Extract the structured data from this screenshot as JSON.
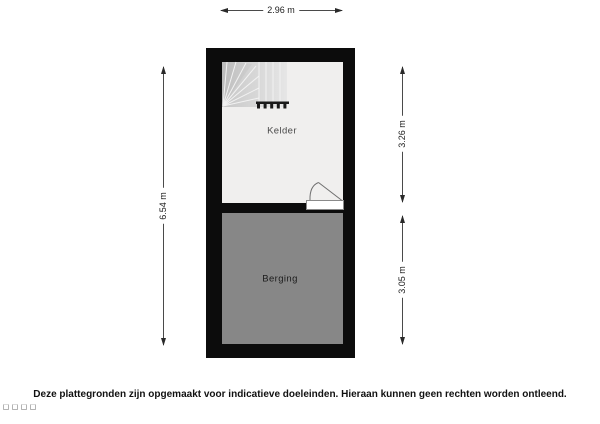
{
  "floorplan": {
    "rooms": {
      "kelder": {
        "label": "Kelder",
        "fill": "#f0efee"
      },
      "berging": {
        "label": "Berging",
        "fill": "#878787"
      }
    },
    "dimensions": {
      "width_top": "2.96 m",
      "height_left": "6.54 m",
      "kelder_right": "3.26 m",
      "berging_right": "3.05 m"
    },
    "wall_color": "#0c0c0c",
    "features": [
      "stairs",
      "door-swing"
    ]
  },
  "footer": {
    "disclaimer": "Deze plattegronden zijn opgemaakt voor indicatieve doeleinden. Hieraan kunnen geen rechten worden ontleend."
  }
}
